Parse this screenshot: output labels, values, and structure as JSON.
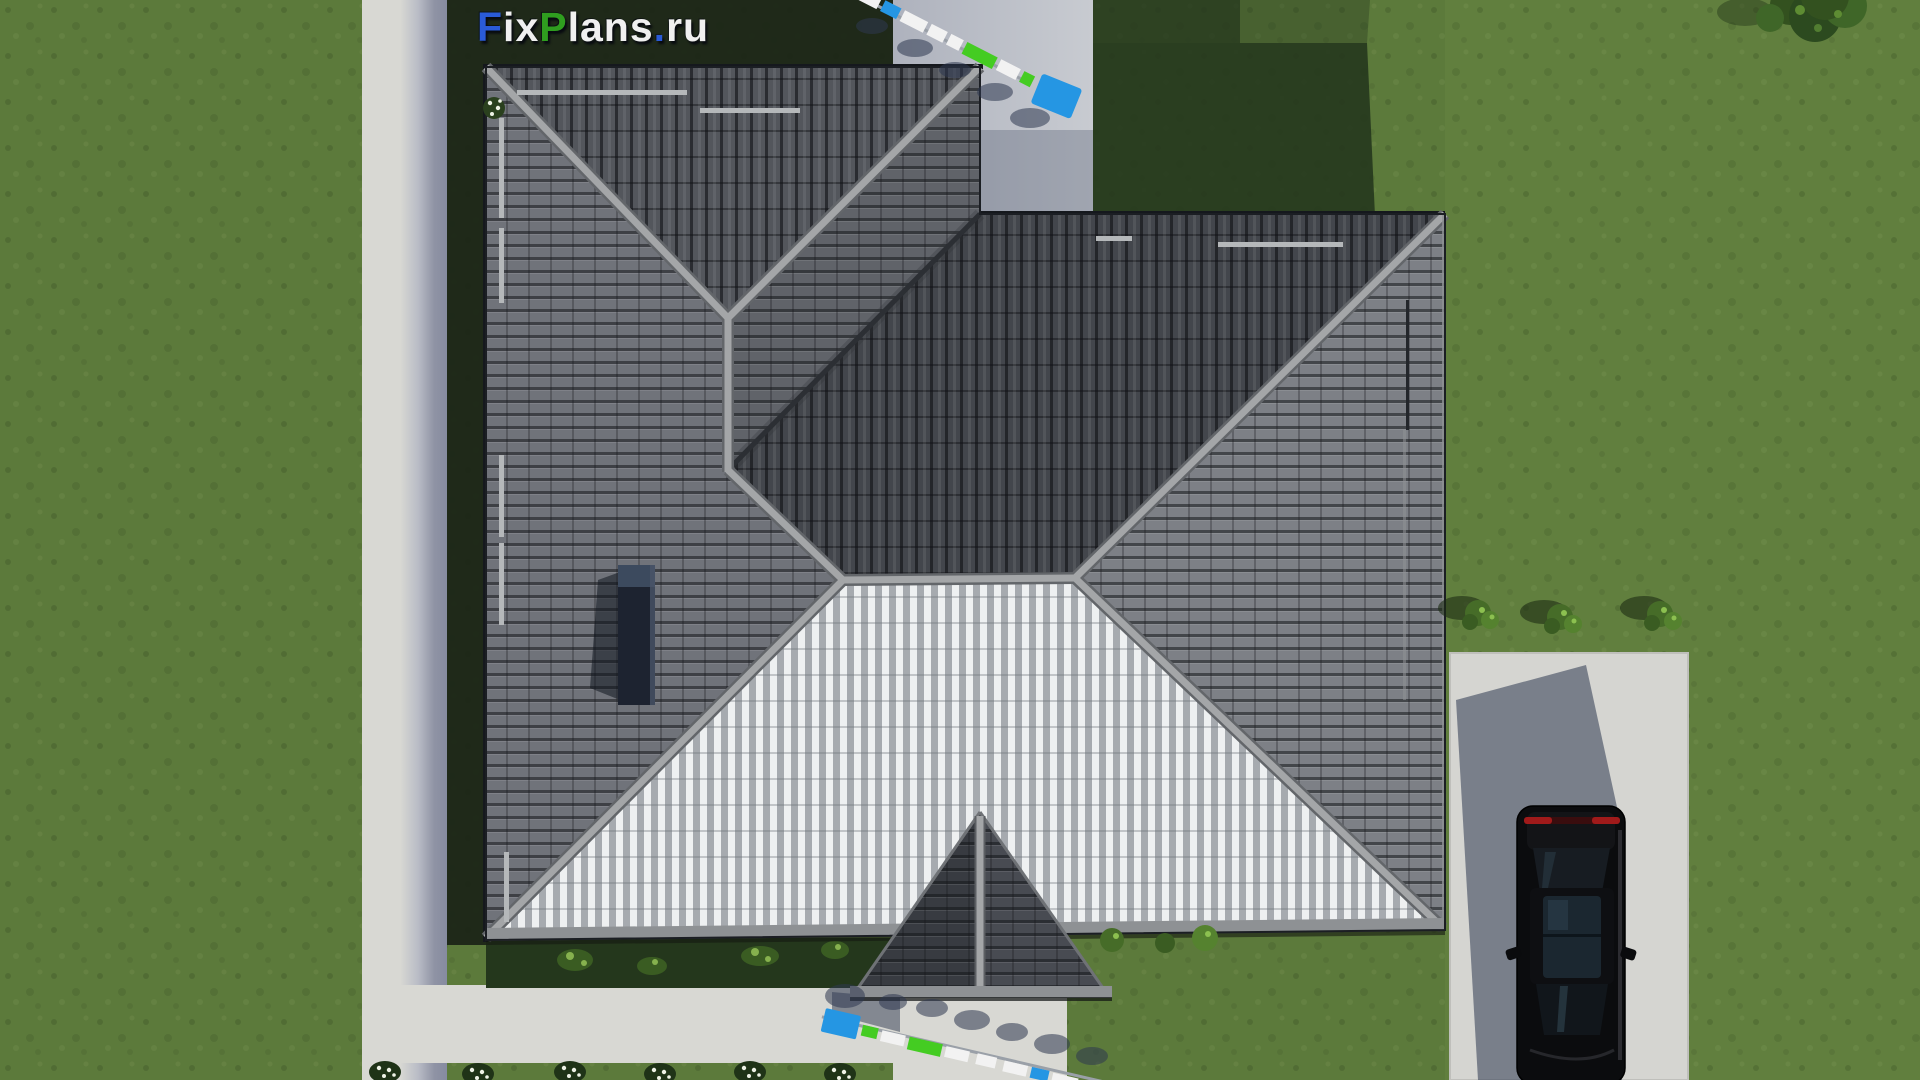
{
  "watermark": {
    "parts": [
      {
        "text": "F",
        "color": "#2a5bd7"
      },
      {
        "text": "ix",
        "color": "#f0f0f0"
      },
      {
        "text": "P",
        "color": "#2f9e1f"
      },
      {
        "text": "lans",
        "color": "#f0f0f0"
      },
      {
        "text": ".",
        "color": "#2a5bd7"
      },
      {
        "text": "ru",
        "color": "#f0f0f0"
      }
    ]
  },
  "palette": {
    "lawn": "#5c7a3b",
    "lawn_light": "#6b8a45",
    "lawn_dark": "#23351d",
    "path": "#d8d8d3",
    "path_shadow": "#8f93a4",
    "pad": "#b9bdc6",
    "driveway": "#d5d5d1",
    "roof_west": "#70737a",
    "roof_east_left": "#606369",
    "roof_north_left": "#53565c",
    "roof_north_right": "#43464c",
    "roof_east_right": "#7d8086",
    "stripe_light": "#eef0f1",
    "stripe_gray": "#a6aaaf",
    "ridge": "#a4a6a8",
    "valley": "#2c2f34",
    "portico_left": "#383b41",
    "portico_right": "#484b52",
    "eave": "#8e9194",
    "chimney": "#1d2330",
    "scale_white": "#f2f2f2",
    "scale_blue": "#2596e3",
    "scale_green": "#44cc22",
    "shadow_navy": "#2e3850",
    "car_body": "#0b0c0e",
    "car_glass": "#1b2730",
    "tail_light": "#a01a1a",
    "bush": "#466c28",
    "bush_light": "#8cc050",
    "flower_white": "#eef2e6",
    "tree": "#33511f",
    "logo_blue": "#2a5bd7",
    "logo_green": "#2f9e1f",
    "logo_white": "#f0f0f0"
  }
}
